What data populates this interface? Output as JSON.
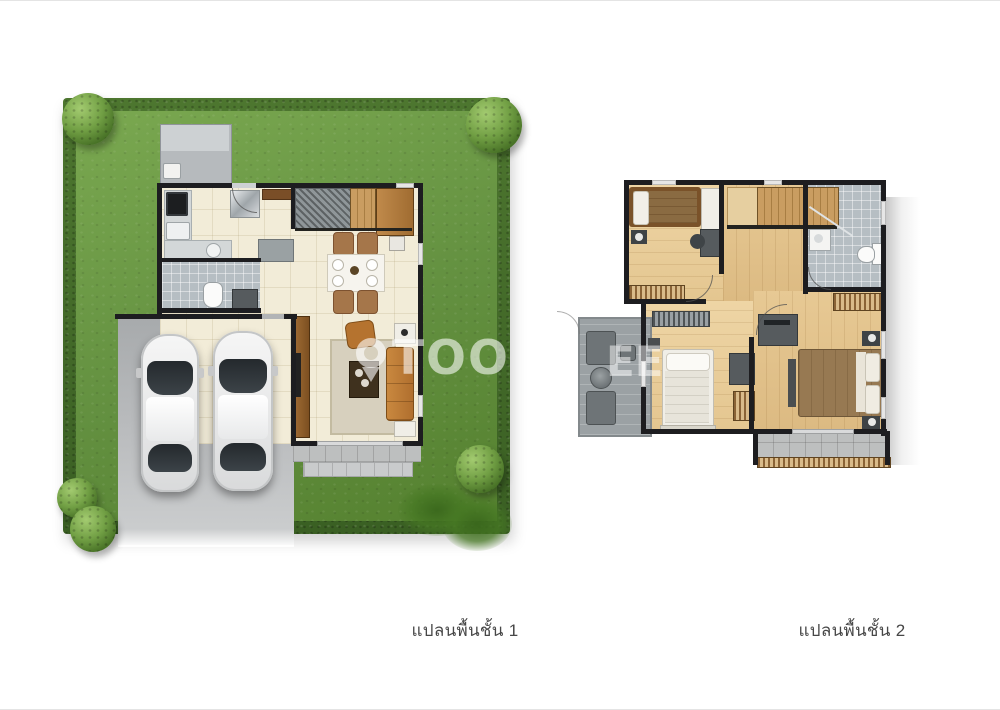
{
  "captions": {
    "floor1": "แปลนพื้นชั้น 1",
    "floor2": "แปลนพื้นชั้น 2"
  },
  "watermark": {
    "icon": "location-pin-icon",
    "text_left": "TOO",
    "text_right": "EE",
    "color": "#ffffff",
    "opacity": 0.58
  },
  "palette": {
    "lawn_green": "#639040",
    "hedge_green": "#44692a",
    "tree_green": "#4a7428",
    "driveway_gray": "#b8babc",
    "floor_cream": "#f2ecd8",
    "wood_floor": "#e0bf87",
    "bath_tile_gray": "#b6bec3",
    "balcony_gray": "#9ba1a4",
    "wall_black": "#1d1d20",
    "sofa_tan": "#bf7c35",
    "caption_text": "#474747",
    "page_background": "#ffffff"
  }
}
